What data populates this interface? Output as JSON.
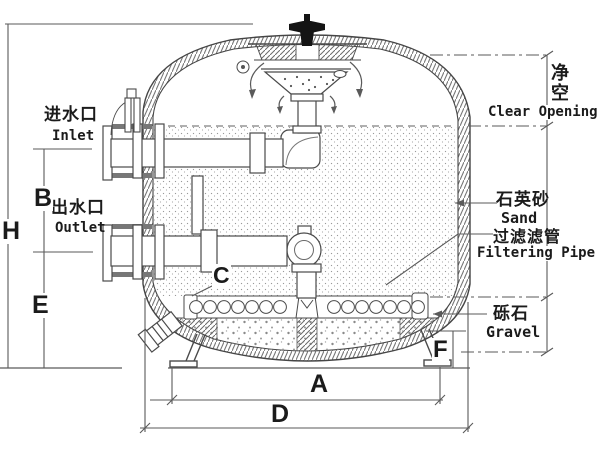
{
  "drawing": {
    "connections": {
      "inlet": {
        "cn": "进水口",
        "en": "Inlet"
      },
      "outlet": {
        "cn": "出水口",
        "en": "Outlet"
      }
    },
    "annotations": {
      "clear_opening": {
        "cn": "净\n空",
        "en": "Clear Opening"
      },
      "sand": {
        "cn": "石英砂",
        "en": "Sand"
      },
      "filtering_pipe": {
        "cn": "过滤滤管",
        "en": "Filtering Pipe"
      },
      "gravel": {
        "cn": "砾石",
        "en": "Gravel"
      }
    },
    "dimension_letters": {
      "overall_height": "H",
      "inlet_outlet_spacing": "B",
      "outlet_height": "E",
      "lateral_header": "C",
      "leg_span": "A",
      "overall_width": "D",
      "base_clearance": "F"
    },
    "colors": {
      "line": "#3f3f3f",
      "dim_line": "#5a5a5a",
      "valve": "#141414",
      "sand_dot": "#9a9a9a",
      "background": "#ffffff"
    }
  }
}
